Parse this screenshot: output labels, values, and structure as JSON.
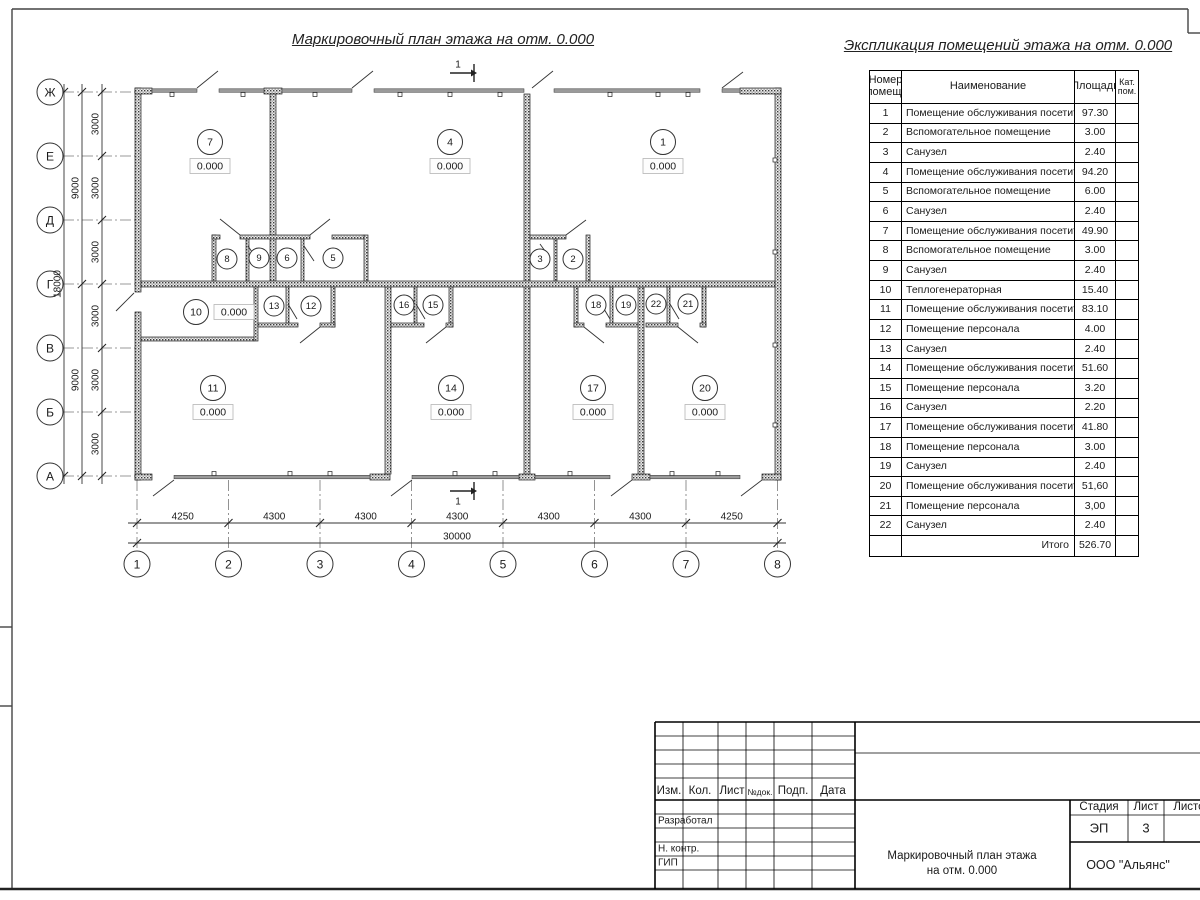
{
  "page": {
    "plan_title": "Маркировочный план этажа на отм. 0.000",
    "table_title": "Экспликация помещений этажа на отм. 0.000"
  },
  "table": {
    "headers": {
      "num": "Номер\nпомещ.",
      "name": "Наименование",
      "area": "Площадь",
      "cat": "Кат.\nпом."
    },
    "rows": [
      {
        "num": "1",
        "name": "Помещение обслуживания посетителей",
        "area": "97.30"
      },
      {
        "num": "2",
        "name": "Вспомогательное помещение",
        "area": "3.00"
      },
      {
        "num": "3",
        "name": "Санузел",
        "area": "2.40"
      },
      {
        "num": "4",
        "name": "Помещение обслуживания посетителей",
        "area": "94.20"
      },
      {
        "num": "5",
        "name": "Вспомогательное помещение",
        "area": "6.00"
      },
      {
        "num": "6",
        "name": "Санузел",
        "area": "2.40"
      },
      {
        "num": "7",
        "name": "Помещение обслуживания посетителей",
        "area": "49.90"
      },
      {
        "num": "8",
        "name": "Вспомогательное помещение",
        "area": "3.00"
      },
      {
        "num": "9",
        "name": "Санузел",
        "area": "2.40"
      },
      {
        "num": "10",
        "name": "Теплогенераторная",
        "area": "15.40"
      },
      {
        "num": "11",
        "name": "Помещение обслуживания посетителей",
        "area": "83.10"
      },
      {
        "num": "12",
        "name": "Помещение персонала",
        "area": "4.00"
      },
      {
        "num": "13",
        "name": "Санузел",
        "area": "2.40"
      },
      {
        "num": "14",
        "name": "Помещение обслуживания посетителей",
        "area": "51.60"
      },
      {
        "num": "15",
        "name": "Помещение персонала",
        "area": "3.20"
      },
      {
        "num": "16",
        "name": "Санузел",
        "area": "2.20"
      },
      {
        "num": "17",
        "name": "Помещение обслуживания посетителей",
        "area": "41.80"
      },
      {
        "num": "18",
        "name": "Помещение персонала",
        "area": "3.00"
      },
      {
        "num": "19",
        "name": "Санузел",
        "area": "2.40"
      },
      {
        "num": "20",
        "name": "Помещение обслуживания посетителей",
        "area": "51,60"
      },
      {
        "num": "21",
        "name": "Помещение персонала",
        "area": "3,00"
      },
      {
        "num": "22",
        "name": "Санузел",
        "area": "2.40"
      }
    ],
    "total_label": "Итого",
    "total_value": "526.70"
  },
  "plan": {
    "axes_rows": [
      "Ж",
      "Е",
      "Д",
      "Г",
      "В",
      "Б",
      "А"
    ],
    "axes_cols": [
      "1",
      "2",
      "3",
      "4",
      "5",
      "6",
      "7",
      "8"
    ],
    "dims_bottom": [
      "4250",
      "4300",
      "4300",
      "4300",
      "4300",
      "4300",
      "4250"
    ],
    "dim_total": "30000",
    "dims_left_segments": [
      "3000",
      "3000",
      "3000",
      "3000",
      "3000",
      "3000"
    ],
    "dims_left_halves": [
      "9000",
      "9000"
    ],
    "dim_left_total": "18000",
    "section_mark": "1",
    "elevation_mark": "0.000",
    "rooms_with_elevation": [
      "7",
      "4",
      "1",
      "10",
      "11",
      "14",
      "17",
      "20"
    ],
    "rooms_small": [
      "8",
      "9",
      "6",
      "5",
      "3",
      "2",
      "13",
      "12",
      "16",
      "15",
      "18",
      "19",
      "22",
      "21"
    ]
  },
  "title_block": {
    "cols": [
      "Изм.",
      "Кол.",
      "Лист",
      "№док.",
      "Подп.",
      "Дата"
    ],
    "row_labels": [
      "Разработал",
      "Н. контр.",
      "ГИП"
    ],
    "stage_label": "Стадия",
    "sheet_label": "Лист",
    "sheets_label": "Листов",
    "stage_value": "ЭП",
    "sheet_value": "3",
    "doc_title_line1": "Маркировочный план этажа",
    "doc_title_line2": "на отм. 0.000",
    "company": "ООО \"Альянс\""
  }
}
